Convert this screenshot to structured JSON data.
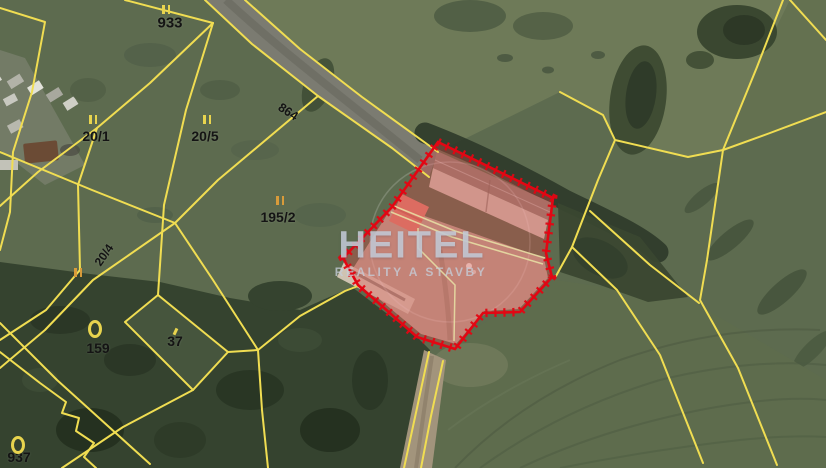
{
  "map": {
    "type": "cadastral-satellite-view",
    "watermark": {
      "title": "HEITEL",
      "subtitle": "REALITY A STAVBY"
    },
    "labels": [
      {
        "text": "933"
      },
      {
        "text": "20/1"
      },
      {
        "text": "20/5"
      },
      {
        "text": "195/2"
      },
      {
        "text": "20/4"
      },
      {
        "text": "864"
      },
      {
        "text": "159"
      },
      {
        "text": "37"
      },
      {
        "text": "937"
      }
    ],
    "colors": {
      "cadastral_line": "#f0dd52",
      "cadastral_line_inner": "#e9e3a6",
      "highlight_stroke": "#e30613",
      "highlight_fill": "rgba(228,70,70,0.33)",
      "label_text": "#141414",
      "watermark": "rgba(197,205,216,0.85)"
    },
    "icons": {
      "landuse_double_bar": "||",
      "landuse_ring": "0"
    }
  }
}
